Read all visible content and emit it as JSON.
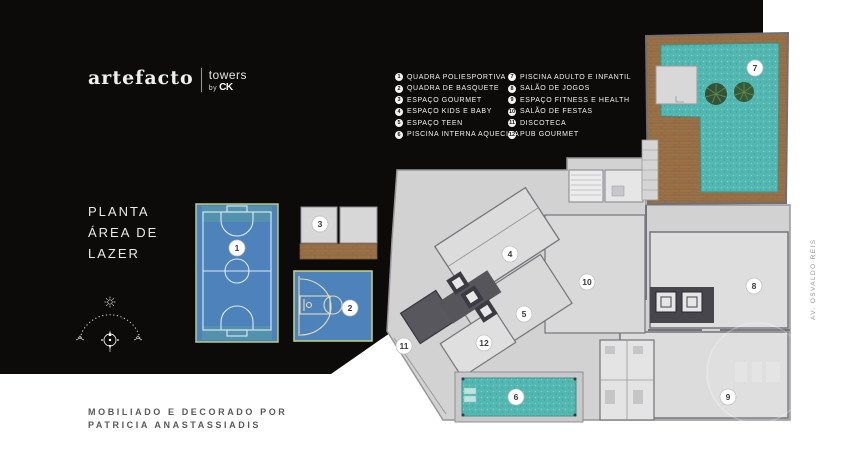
{
  "brand": {
    "name": "artefacto",
    "product": "towers",
    "by": "by",
    "by_logo": "CK"
  },
  "title": {
    "line1": "PLANTA",
    "line2": "ÁREA DE",
    "line3": "LAZER"
  },
  "legend": {
    "col1": [
      {
        "n": "1",
        "label": "QUADRA POLIESPORTIVA"
      },
      {
        "n": "2",
        "label": "QUADRA DE BASQUETE"
      },
      {
        "n": "3",
        "label": "ESPAÇO GOURMET"
      },
      {
        "n": "4",
        "label": "ESPAÇO KIDS E BABY"
      },
      {
        "n": "5",
        "label": "ESPAÇO TEEN"
      },
      {
        "n": "6",
        "label": "PISCINA INTERNA AQUECIDA"
      }
    ],
    "col2": [
      {
        "n": "7",
        "label": "PISCINA ADULTO E INFANTIL"
      },
      {
        "n": "8",
        "label": "SALÃO DE JOGOS"
      },
      {
        "n": "9",
        "label": "ESPAÇO FITNESS E HEALTH"
      },
      {
        "n": "10",
        "label": "SALÃO DE FESTAS"
      },
      {
        "n": "11",
        "label": "DISCOTECA"
      },
      {
        "n": "12",
        "label": "PUB GOURMET"
      }
    ]
  },
  "plan": {
    "markers": [
      {
        "n": "1",
        "x": 237,
        "y": 248
      },
      {
        "n": "2",
        "x": 350,
        "y": 308
      },
      {
        "n": "3",
        "x": 320,
        "y": 224
      },
      {
        "n": "4",
        "x": 510,
        "y": 254
      },
      {
        "n": "5",
        "x": 524,
        "y": 314
      },
      {
        "n": "6",
        "x": 516,
        "y": 397
      },
      {
        "n": "7",
        "x": 755,
        "y": 68
      },
      {
        "n": "8",
        "x": 754,
        "y": 286
      },
      {
        "n": "9",
        "x": 728,
        "y": 397
      },
      {
        "n": "10",
        "x": 587,
        "y": 282
      },
      {
        "n": "11",
        "x": 404,
        "y": 346
      },
      {
        "n": "12",
        "x": 484,
        "y": 343
      }
    ]
  },
  "footer": {
    "line1": "MOBILIADO E DECORADO POR",
    "line2": "PATRICIA ANASTASSIADIS"
  },
  "street_label": "AV. OSVALDO REIS",
  "colors": {
    "background_black": "#0c0b0a",
    "page_white": "#ffffff",
    "court_blue": "#4d82ba",
    "court_border": "#bccf7c",
    "water_teal": "#52b7b1",
    "wood_brown": "#9a7147",
    "slab_gray": "#d2d2d3",
    "room_gray": "#dededf",
    "wall_gray": "#74747a",
    "text_gray": "#58595b"
  }
}
